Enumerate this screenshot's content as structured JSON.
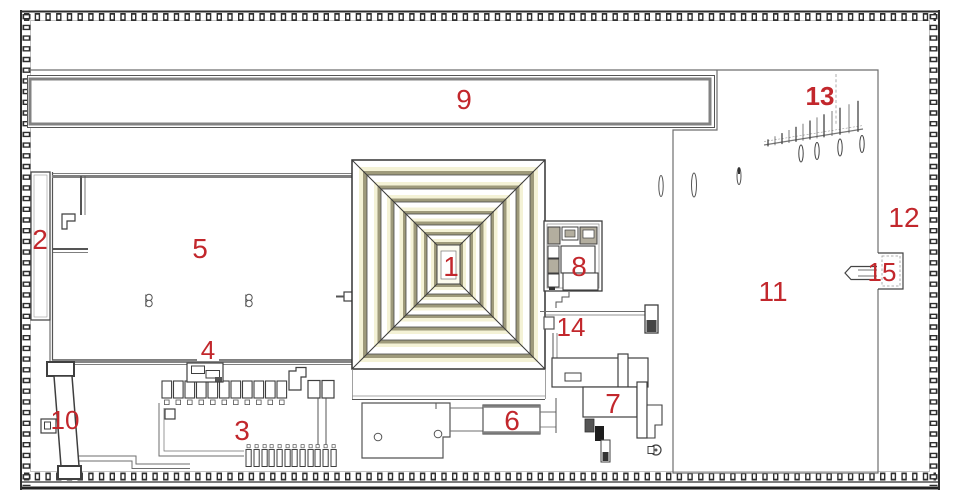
{
  "plan": {
    "labels": {
      "n1": "1",
      "n2": "2",
      "n3": "3",
      "n4": "4",
      "n5": "5",
      "n6": "6",
      "n7": "7",
      "n8": "8",
      "n9": "9",
      "n10": "10",
      "n11": "11",
      "n12": "12",
      "n13": "13",
      "n14": "14",
      "n15": "15"
    },
    "palette": {
      "label_red": "#c2272c",
      "pyramid_olive": "#9e9a7b",
      "pyramid_cream": "#f4f2d6",
      "pyramid_center": "#fcfbee",
      "room_tan": "#b3ae9f",
      "wall_dark": "#2e2e2e",
      "line_dark": "#3f3f3f",
      "line_gray": "#808080",
      "line_faint": "#b5b5b5"
    }
  }
}
